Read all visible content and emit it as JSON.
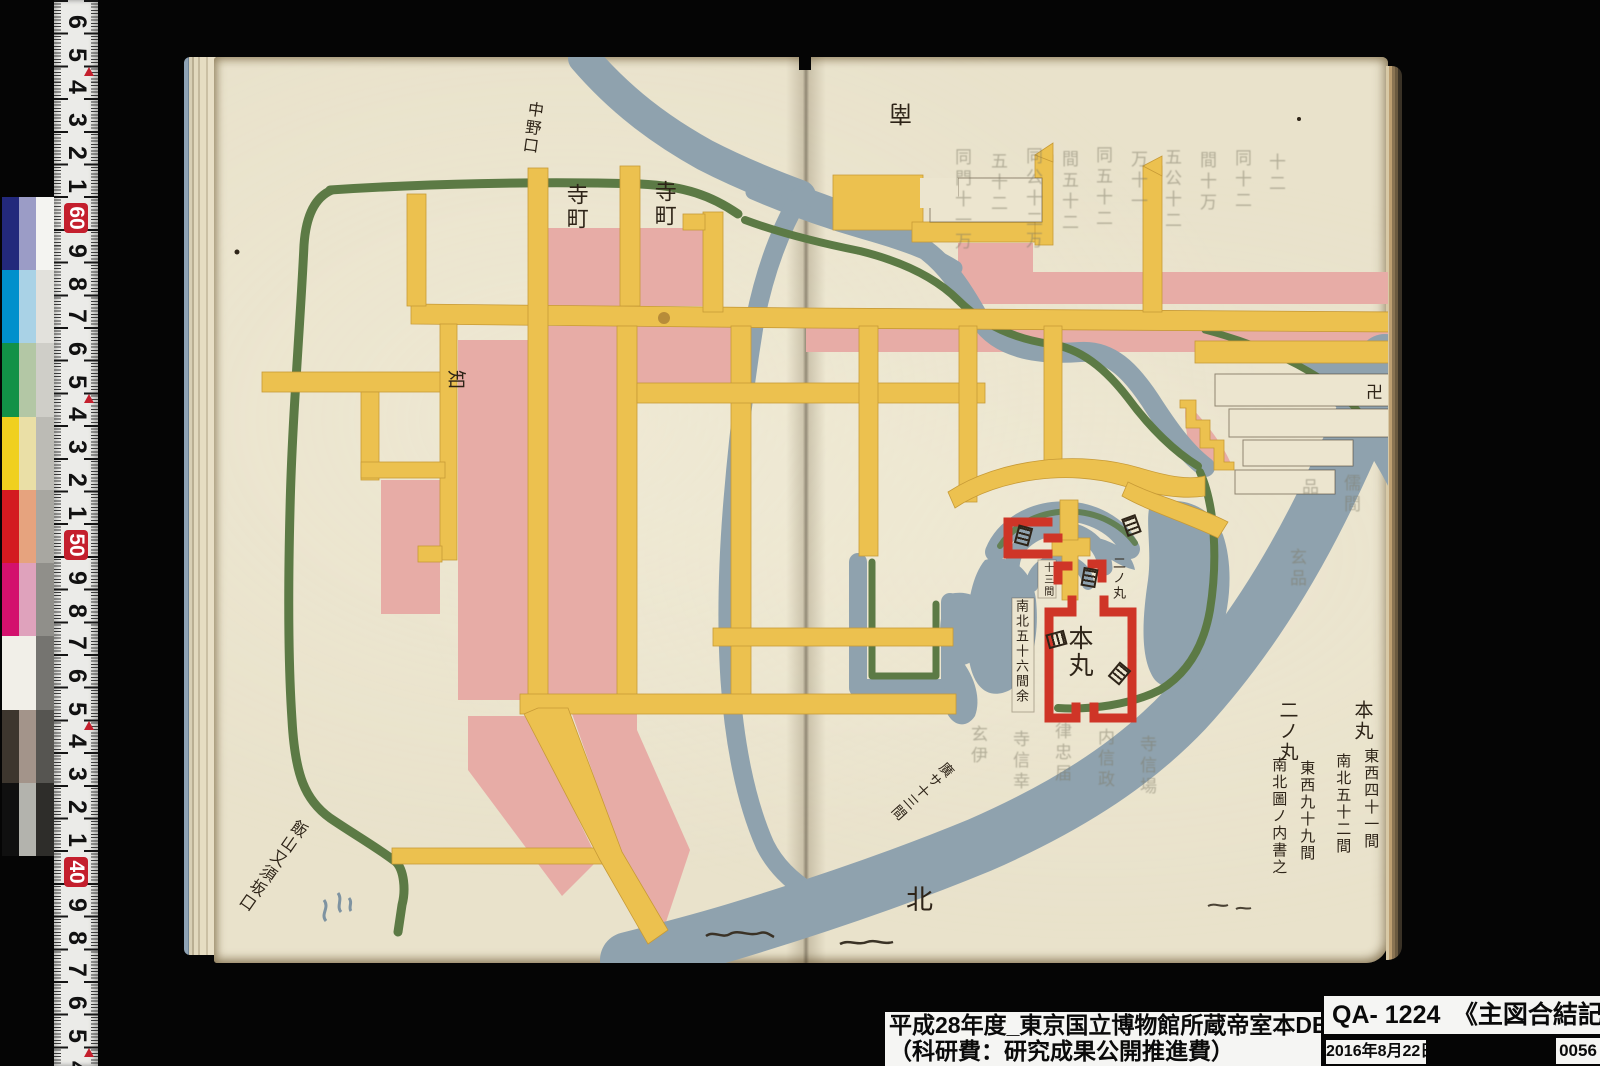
{
  "photo": {
    "description": "Museum digitization photograph of an open book spread with a hand-painted Edo-period castle town map",
    "catalog_colors": {
      "paper": "#e9e2cb",
      "road_yellow": "#ecc14f",
      "block_pink": "#e7aca6",
      "river_blue": "#8fa2ae",
      "bank_green": "#5c7a45",
      "castle_red": "#cf3527",
      "ink": "#2e2418"
    }
  },
  "calibration": {
    "ruler": {
      "numbers": [
        "6",
        "5",
        "4",
        "3",
        "2",
        "1",
        "60",
        "9",
        "8",
        "7",
        "6",
        "5",
        "4",
        "3",
        "2",
        "1",
        "50",
        "9",
        "8",
        "7",
        "6",
        "5",
        "4",
        "3",
        "2",
        "1",
        "40",
        "9",
        "8",
        "7",
        "6",
        "5",
        "4"
      ],
      "badge_indices": [
        6,
        16,
        26
      ],
      "arrow_indices": [
        1,
        11,
        21,
        31
      ],
      "badge_color": "#c41f2d"
    },
    "patch_rows": [
      {
        "left": "#23297c",
        "right": "#9b9cc6"
      },
      {
        "left": "#0090cc",
        "right": "#a9d2e6"
      },
      {
        "left": "#129147",
        "right": "#b3c7a5"
      },
      {
        "left": "#f0d01e",
        "right": "#eadfa6"
      },
      {
        "left": "#d31a20",
        "right": "#e6a37e"
      },
      {
        "left": "#d3116d",
        "right": "#dfa2bc"
      },
      {
        "left": "#f1efe8",
        "right": "#f1efe8"
      },
      {
        "left": "#3d362e",
        "right": "#a3948a"
      },
      {
        "left": "#101010",
        "right": "#b3b3ad"
      }
    ],
    "gray_steps": [
      "#f4f4f1",
      "#e2e1dc",
      "#cfcec8",
      "#bcbbb5",
      "#a8a7a1",
      "#908f8a",
      "#757470",
      "#565551",
      "#2e2d2a"
    ]
  },
  "map": {
    "ink_labels": [
      {
        "t": "寺町",
        "x": 563,
        "y": 183,
        "s": 22,
        "v": 1,
        "r": 0
      },
      {
        "t": "寺町",
        "x": 651,
        "y": 180,
        "s": 22,
        "v": 1,
        "r": 0
      },
      {
        "t": "中野口",
        "x": 527,
        "y": 100,
        "s": 16,
        "v": 1,
        "r": 8
      },
      {
        "t": "知",
        "x": 466,
        "y": 370,
        "s": 19,
        "v": 0,
        "r": 90
      },
      {
        "t": "南",
        "x": 912,
        "y": 125,
        "s": 23,
        "v": 0,
        "r": 180
      },
      {
        "t": "卍",
        "x": 1366,
        "y": 384,
        "s": 17,
        "v": 0,
        "r": 0
      },
      {
        "t": "本丸",
        "x": 1066,
        "y": 625,
        "s": 25,
        "v": 1,
        "r": 0
      },
      {
        "t": "二ノ丸",
        "x": 1110,
        "y": 556,
        "s": 13,
        "v": 1,
        "r": 0
      },
      {
        "t": "十三間",
        "x": 1041,
        "y": 562,
        "s": 10,
        "v": 1,
        "r": 0
      },
      {
        "t": "南北五十六間余",
        "x": 1013,
        "y": 599,
        "s": 13,
        "v": 1,
        "r": 0
      },
      {
        "t": "飯山又須坂口",
        "x": 296,
        "y": 816,
        "s": 16,
        "v": 1,
        "r": 35
      },
      {
        "t": "廣サ十三間",
        "x": 946,
        "y": 758,
        "s": 14,
        "v": 1,
        "r": 48
      },
      {
        "t": "北",
        "x": 906,
        "y": 886,
        "s": 27,
        "v": 0,
        "r": 0
      },
      {
        "t": "本丸",
        "x": 1352,
        "y": 700,
        "s": 19,
        "v": 1,
        "r": 0
      },
      {
        "t": "東西四十一間",
        "x": 1363,
        "y": 748,
        "s": 15,
        "v": 1,
        "r": 0
      },
      {
        "t": "南北五十二間",
        "x": 1335,
        "y": 753,
        "s": 15,
        "v": 1,
        "r": 0
      },
      {
        "t": "二ノ丸",
        "x": 1277,
        "y": 700,
        "s": 19,
        "v": 1,
        "r": 0
      },
      {
        "t": "東西九十九間",
        "x": 1299,
        "y": 760,
        "s": 15,
        "v": 1,
        "r": 0
      },
      {
        "t": "南北圖ノ内書之",
        "x": 1271,
        "y": 757,
        "s": 15,
        "v": 1,
        "r": 0
      }
    ],
    "faint_labels": [
      {
        "t": "同門十一万",
        "x": 949,
        "y": 148
      },
      {
        "t": "五十二",
        "x": 985,
        "y": 152
      },
      {
        "t": "同公十二万",
        "x": 1020,
        "y": 147
      },
      {
        "t": "間五十二",
        "x": 1056,
        "y": 150
      },
      {
        "t": "同五十二",
        "x": 1090,
        "y": 146
      },
      {
        "t": "万十一",
        "x": 1125,
        "y": 150
      },
      {
        "t": "五公十二",
        "x": 1159,
        "y": 148
      },
      {
        "t": "間十万",
        "x": 1194,
        "y": 151
      },
      {
        "t": "同十二",
        "x": 1229,
        "y": 149
      },
      {
        "t": "十二",
        "x": 1263,
        "y": 153
      },
      {
        "t": "品",
        "x": 1296,
        "y": 478
      },
      {
        "t": "儒間",
        "x": 1338,
        "y": 474
      },
      {
        "t": "玄伊",
        "x": 965,
        "y": 725
      },
      {
        "t": "寺信幸",
        "x": 1007,
        "y": 730
      },
      {
        "t": "律忠届",
        "x": 1049,
        "y": 722
      },
      {
        "t": "内信政",
        "x": 1092,
        "y": 728
      },
      {
        "t": "寺信場",
        "x": 1134,
        "y": 735
      },
      {
        "t": "玄品",
        "x": 1284,
        "y": 548
      }
    ],
    "gate_symbols": [
      {
        "x": 1016,
        "y": 526,
        "r": 15
      },
      {
        "x": 1124,
        "y": 516,
        "r": -20
      },
      {
        "x": 1082,
        "y": 568,
        "r": 10
      },
      {
        "x": 1049,
        "y": 630,
        "r": 75
      },
      {
        "x": 1112,
        "y": 664,
        "r": 40
      }
    ]
  },
  "footer": {
    "line1": "平成28年度_東京国立博物館所蔵帝室本DB",
    "line2": "（科研費：研究成果公開推進費）",
    "catalog_line": "QA- 1224　《主図合結記》",
    "date": "2016年8月22日",
    "frame_no": "0056"
  }
}
